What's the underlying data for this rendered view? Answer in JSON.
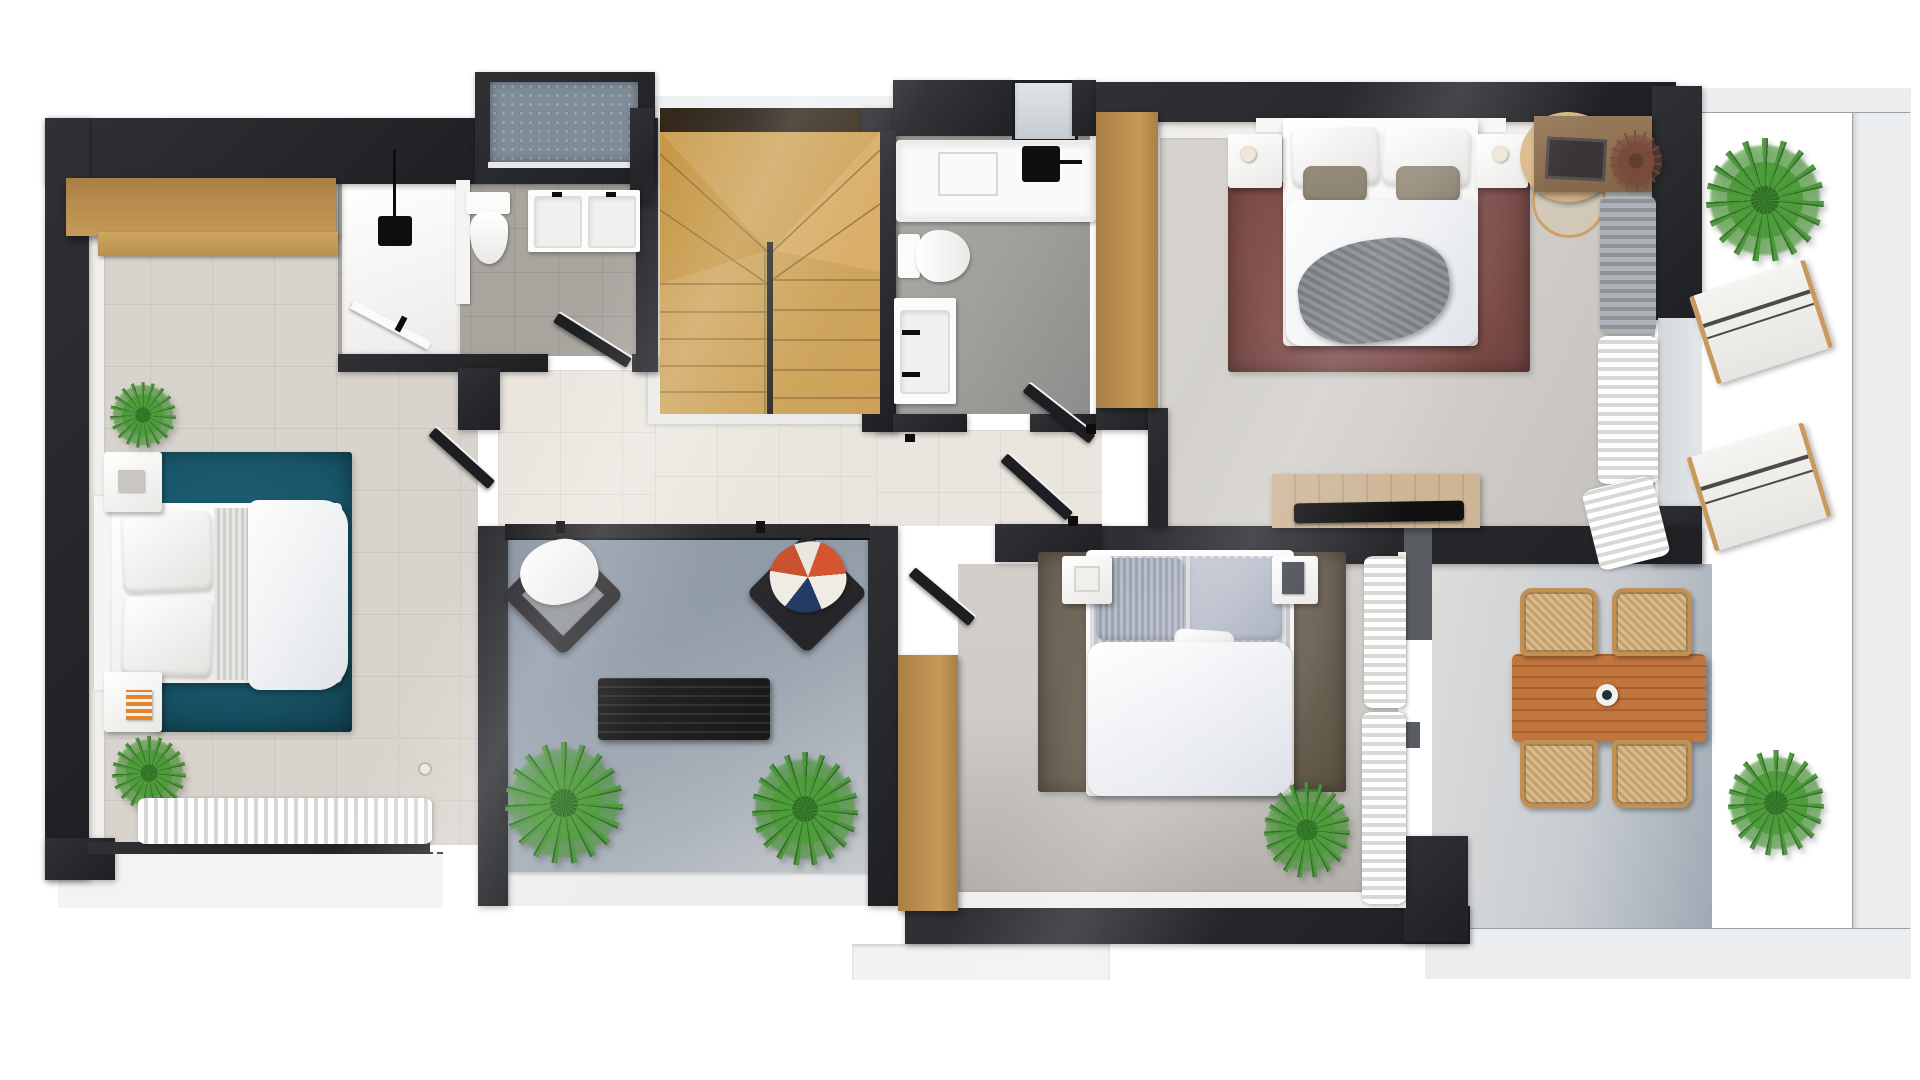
{
  "scene": {
    "type": "3d-rendered-floor-plan-top-view",
    "floor": "upper-floor-apartment",
    "rooms": [
      {
        "name": "bedroom-left",
        "furniture": [
          "long-wood-wardrobe",
          "double-bed",
          "two-nightstands",
          "teal-rug",
          "two-plants",
          "ceiling-fan",
          "window-curtain"
        ]
      },
      {
        "name": "bathroom-1",
        "furniture": [
          "walk-in-shower",
          "toilet",
          "double-sink-vanity",
          "washer-niche"
        ]
      },
      {
        "name": "staircase",
        "furniture": [
          "u-shaped-wood-stair",
          "glazed-strip"
        ]
      },
      {
        "name": "bathroom-2",
        "furniture": [
          "bathtub-shower",
          "toilet",
          "sink-vanity",
          "tall-wood-wardrobe"
        ]
      },
      {
        "name": "bedroom-1-master",
        "furniture": [
          "double-bed",
          "two-nightstands-with-lamps",
          "maroon-rug",
          "vanity-desk-with-stool",
          "curtains",
          "tv-bench"
        ]
      },
      {
        "name": "bedroom-2",
        "furniture": [
          "double-bed",
          "two-nightstands",
          "taupe-rug",
          "tall-wood-wardrobe",
          "plant",
          "curtains"
        ]
      },
      {
        "name": "hallway",
        "furniture": [
          "open-doors"
        ]
      },
      {
        "name": "balcony-center",
        "furniture": [
          "two-lounge-armchairs",
          "black-slat-bench",
          "two-plants"
        ]
      },
      {
        "name": "terrace-right",
        "furniture": [
          "palm-plant",
          "two-sun-loungers",
          "dining-table",
          "four-rattan-chairs",
          "vase",
          "plant"
        ]
      }
    ]
  },
  "palette": {
    "wall": "#27292c",
    "wallDark": "#1b1d1f",
    "floorBedLeft": "#d8d3cc",
    "floorHall": "#eae6df",
    "floorBed1": "#d2cfca",
    "floorBed2": "#cfccc8",
    "floorBath1": "#a9a49e",
    "floorBath2": "#a2a09d",
    "terraceBlue": "#8f9aa7",
    "terraceLight": "#c9cdd2",
    "parapet": "#eceef0",
    "woodCabinet": "#b78a4d",
    "woodShelf": "#cfa75f",
    "woodStairs": "#cda257",
    "woodStairsDark": "#c3953f",
    "woodTable": "#c0763c",
    "rattan": "#d3b385",
    "rugTeal": "#19566a",
    "rugMaroon": "#82504d",
    "rugTaupe": "#6f6558",
    "washerBlue": "#7e8d98",
    "glassDark": "#2d2418",
    "blackFurn": "#151515",
    "plantGreen": "#4f9c3c",
    "plantDark": "#2f7026",
    "curtain": "#f7f7f5",
    "grayBlanket": "#7d8085",
    "white": "#ffffff"
  }
}
